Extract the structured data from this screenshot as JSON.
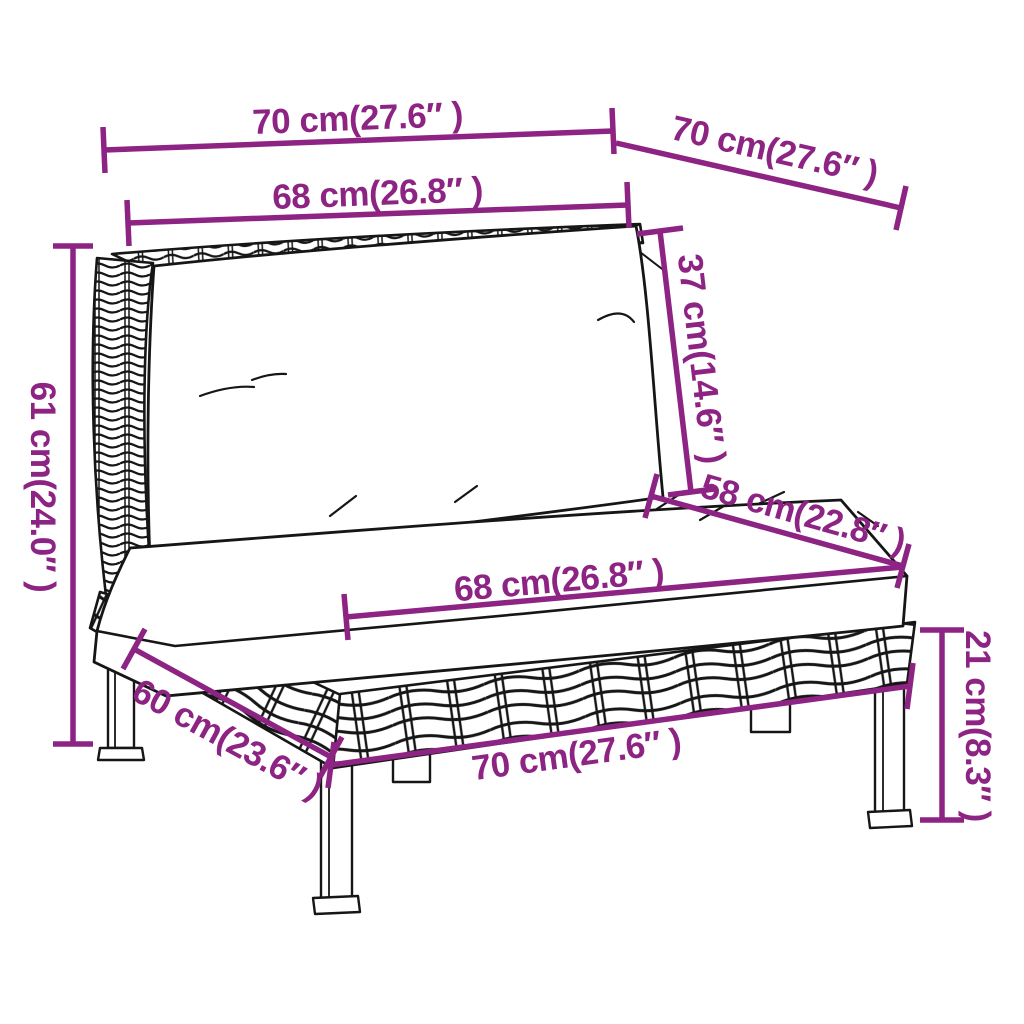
{
  "diagram": {
    "background_color": "#FFFFFF",
    "accent_color": "#8D2383",
    "line_art_color": "#161616",
    "subject": "poly rattan garden sofa middle section with cushions",
    "dimensions": [
      {
        "id": "top-width",
        "label": "70 cm(27.6″ )"
      },
      {
        "id": "top-depth",
        "label": "70 cm(27.6″ )"
      },
      {
        "id": "back-cushion-width",
        "label": "68 cm(26.8″ )"
      },
      {
        "id": "back-cushion-height",
        "label": "37 cm(14.6″ )"
      },
      {
        "id": "total-height",
        "label": "61 cm(24.0″ )"
      },
      {
        "id": "seat-depth",
        "label": "58 cm(22.8″ )"
      },
      {
        "id": "seat-cushion-width",
        "label": "68 cm(26.8″ )"
      },
      {
        "id": "leg-height",
        "label": "21 cm(8.3″ )"
      },
      {
        "id": "base-depth",
        "label": "60 cm(23.6″ )"
      },
      {
        "id": "base-width",
        "label": "70 cm(27.6″ )"
      }
    ]
  }
}
